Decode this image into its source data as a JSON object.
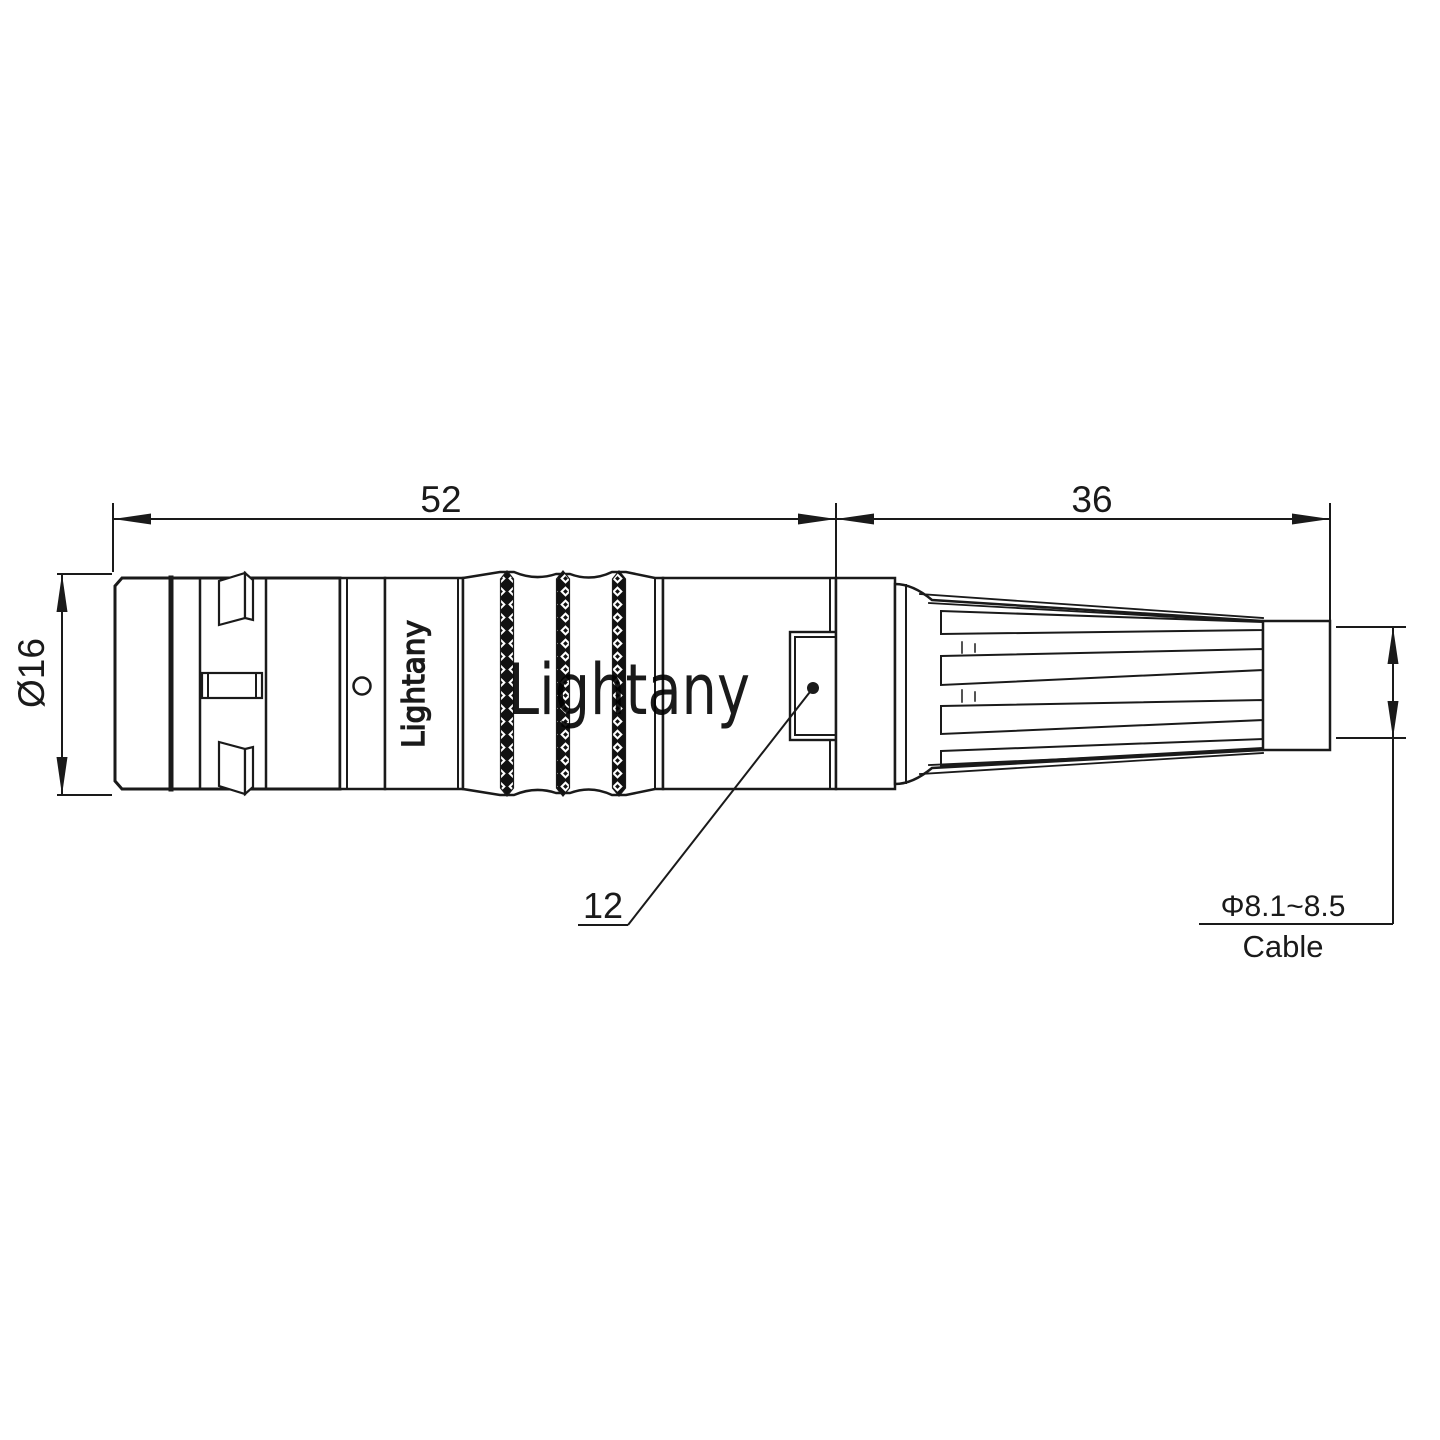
{
  "colors": {
    "background": "#ffffff",
    "line": "#1a1a1a",
    "watermark": "#f3c1c1"
  },
  "branding": {
    "watermark": "Lightany",
    "shell_marking": "Lightany"
  },
  "dimensions": {
    "front_length": "52",
    "boot_length": "36",
    "body_diameter": "Ø16",
    "window_size": "12",
    "cable_diameter": "Φ8.1~8.5",
    "cable_label": "Cable"
  }
}
